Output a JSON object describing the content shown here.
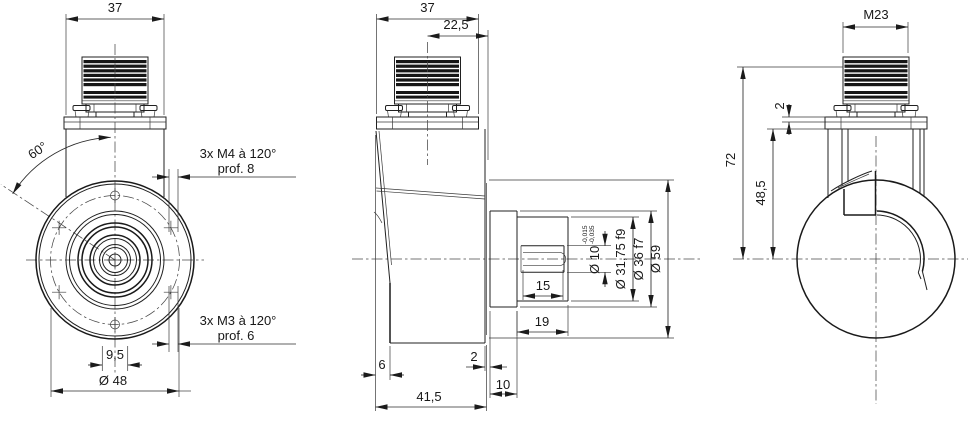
{
  "drawing": {
    "kind": "encoder-dimensional-drawing",
    "line_color": "#1a1a1a",
    "background": "#ffffff"
  },
  "views": {
    "front": {
      "dims": {
        "width": "37",
        "angle": "60°",
        "m4_pattern": "3x M4 à 120°",
        "m4_depth": "prof. 8",
        "m3_pattern": "3x M3 à 120°",
        "m3_depth": "prof. 6",
        "key_width": "9,5",
        "bolt_circle_dia": "Ø 48"
      }
    },
    "side": {
      "dims": {
        "width": "37",
        "connector_offset": "22,5",
        "keyway_length": "15",
        "shaft_length": "19",
        "rear_step": "6",
        "collar_step": "2",
        "spigot_length": "10",
        "housing_length": "41,5",
        "shaft_dia": "Ø 10",
        "shaft_tol_upper": "-0,015",
        "shaft_tol_lower": "-0,035",
        "pilot_dia": "Ø 31,75 f9",
        "spigot_dia": "Ø 36 f7",
        "body_dia": "Ø 59"
      }
    },
    "rear": {
      "dims": {
        "thread": "M23",
        "plate_thickness": "2",
        "total_height": "72",
        "flange_height": "48,5"
      }
    }
  }
}
